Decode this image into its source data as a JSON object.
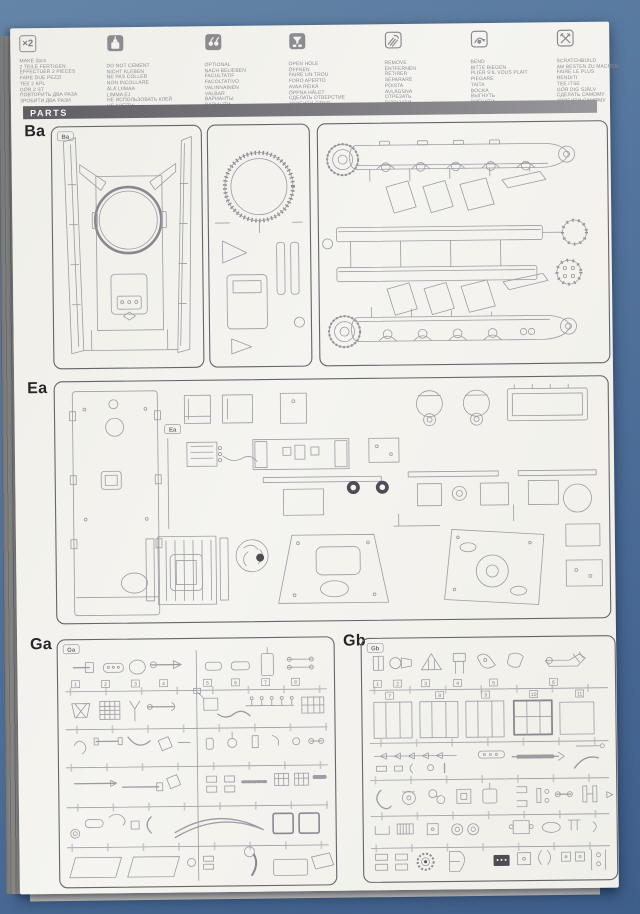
{
  "page": {
    "parts_label": "PARTS"
  },
  "legend": {
    "columns": [
      {
        "icon": "x2-icon",
        "symbol": "×2",
        "text": "MAKE 2pcs\n2 TEILE FERTIGEN\nEFFECTUER 2 PIECES\nFARE DUE PEZZI\nTEE 2 KPL\nGÖR 2 ST\nПОВТОРИТЬ ДВА РАЗА\nЗРОБИТИ ДВА РАЗИ"
      },
      {
        "icon": "no-glue-icon",
        "text": "DO NOT CEMENT\nNICHT KLEBEN\nNE PAS COLLER\nNON INCOLLARE\nÄLÄ LIIMAA\nLIMMA EJ\nНЕ ИСПОЛЬЗОВАТЬ КЛЕЙ\nНЕ КЛЕЇТИ"
      },
      {
        "icon": "optional-icon",
        "text": "OPTIONAL\nNACH BELIEBEN\nFACULTATIF\nFACOLTATIVO\nVALINNAINEN\nVALBAR\nВАРИАНТЫ\nВАРІАНТИ"
      },
      {
        "icon": "open-hole-icon",
        "text": "OPEN HOLE\nÖFFNEN\nFAIRE UN TROU\nFORO APERTO\nAVAA REIKÄ\nÖPPNA HÅLET\nСДЕЛАТЬ ОТВЕРСТИЕ\nЗРОБИТИ ОТВІР"
      },
      {
        "icon": "remove-icon",
        "text": "REMOVE\nENTFERNEN\nRETIRER\nSEPARARE\nPOISTA\nAVLÄGSNA\nОТРЕЗАТЬ\nВІДРІЗАТИ"
      },
      {
        "icon": "bend-icon",
        "text": "BEND\nBITTE BIEGEN\nPLIER S'IL VOUS PLAIT\nPIEGARE\nTAITA\nBOCKA\nВЫГНУТЬ\nВИГНУТИ"
      },
      {
        "icon": "scratchbuild-icon",
        "text": "SCRATCHBUILD\nAM BESTEN ZU MACHEN\nFAIRE LE PLUS\nRENDITI\nTEE ITSE\nGÖR DIG SJÄLV\nСДЕЛАТЬ САМОМУ\nЗРОБИТИ САМОМУ"
      }
    ]
  },
  "sections": {
    "ba": {
      "label": "Ba",
      "marker": "Ba"
    },
    "ea": {
      "label": "Ea",
      "marker": "Ea"
    },
    "ga": {
      "label": "Ga",
      "marker": "Ga",
      "numbers": [
        "1",
        "2",
        "3",
        "4",
        "5",
        "6",
        "7",
        "8"
      ]
    },
    "gb": {
      "label": "Gb",
      "marker": "Gb",
      "numbers_row1": [
        "1",
        "2",
        "3",
        "4",
        "5",
        "6"
      ],
      "numbers_row2": [
        "7",
        "8",
        "9",
        "10",
        "11"
      ]
    }
  },
  "colors": {
    "backdrop": "#4c6e99",
    "paper": "#f5f4f0",
    "bar": "#7d7d81",
    "print": "#9d9ba3",
    "label": "#26262a"
  }
}
